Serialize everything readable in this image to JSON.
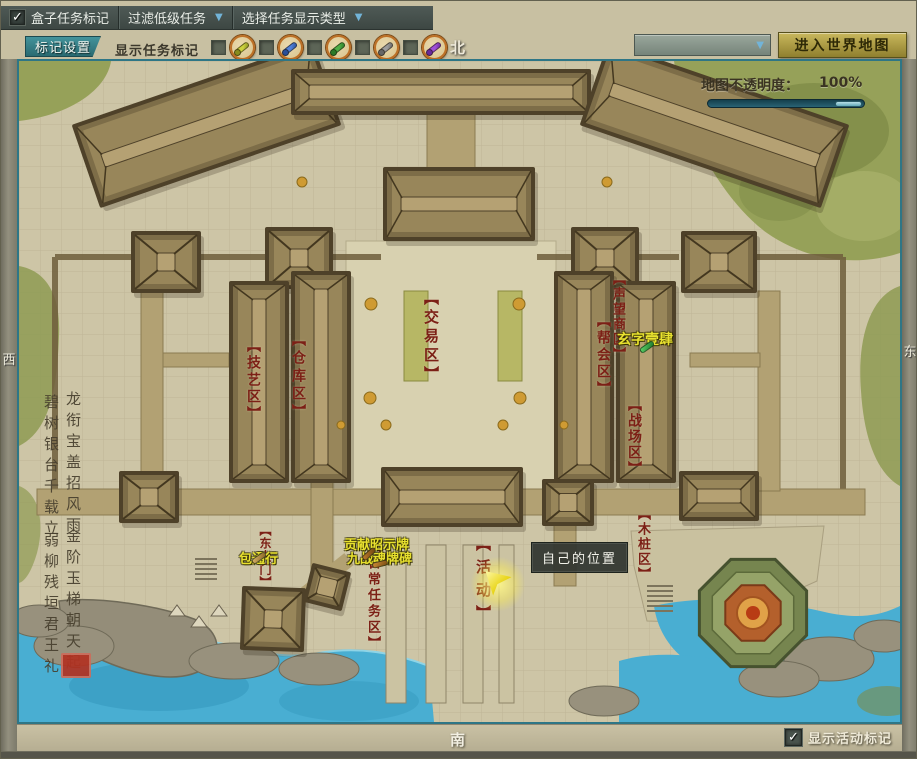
{
  "icons": {
    "check": "✓",
    "arrow_down": "▼"
  },
  "toolbar": {
    "box_task": {
      "label": "盒子任务标记",
      "checked": true
    },
    "filter_low_tasks": {
      "label": "过滤低级任务"
    },
    "task_display_type": {
      "label": "选择任务显示类型"
    },
    "mark_settings_button": "标记设置",
    "show_task_marks_label": "显示任务标记",
    "task_mark_toggles": [
      {
        "name": "yellow-scroll",
        "color": "#ccd23e",
        "dark": "#878d1d",
        "checked": false
      },
      {
        "name": "blue-scroll",
        "color": "#5080d8",
        "dark": "#2a4f9a",
        "checked": false
      },
      {
        "name": "green-scroll",
        "color": "#4fae46",
        "dark": "#2c7a28",
        "checked": false
      },
      {
        "name": "gray-scroll",
        "color": "#9c9c9c",
        "dark": "#666666",
        "checked": false
      },
      {
        "name": "purple-scroll",
        "color": "#a050d8",
        "dark": "#6a2a9a",
        "checked": false
      }
    ],
    "region_select": {
      "value": ""
    },
    "enter_world_map_button": "进入世界地图"
  },
  "compass": {
    "north": "北",
    "south": "南",
    "west": "西",
    "east": "东"
  },
  "map": {
    "opacity": {
      "label": "地图不透明度：",
      "value": "100%",
      "percent": 100
    },
    "area_labels": [
      {
        "id": "trade-area",
        "text": "【交易区】"
      },
      {
        "id": "craft-area",
        "text": "【技艺区】"
      },
      {
        "id": "warehouse-area",
        "text": "【仓库区】"
      },
      {
        "id": "reputation-shop",
        "text": "【声望商区】"
      },
      {
        "id": "guild-area",
        "text": "【帮会区】"
      },
      {
        "id": "battlefield",
        "text": "【战场区】"
      },
      {
        "id": "dummy-area",
        "text": "【木桩区】"
      },
      {
        "id": "east-gate",
        "text": "【东大门】"
      },
      {
        "id": "daily-task-area",
        "text": "【日常任务区】"
      },
      {
        "id": "activity-area",
        "text": "【活动】"
      }
    ],
    "task_markers": [
      {
        "id": "bao-tong-xing",
        "text": "包通行"
      },
      {
        "id": "contribution-board",
        "text": "贡献昭示牌"
      },
      {
        "id": "battle-soul-tablet",
        "text": "九战魂牌碑"
      },
      {
        "id": "xuan-zi-yi-si",
        "text": "玄字壹肆"
      }
    ],
    "player_tooltip": "自己的位置",
    "poem": {
      "lines": [
        "龙衔宝盖招风雨",
        "碧树银台千载立",
        "金阶玉梯朝天起",
        "弱柳残垣君王礼"
      ]
    }
  },
  "footer": {
    "show_activity_marks": {
      "label": "显示活动标记",
      "checked": true
    }
  }
}
